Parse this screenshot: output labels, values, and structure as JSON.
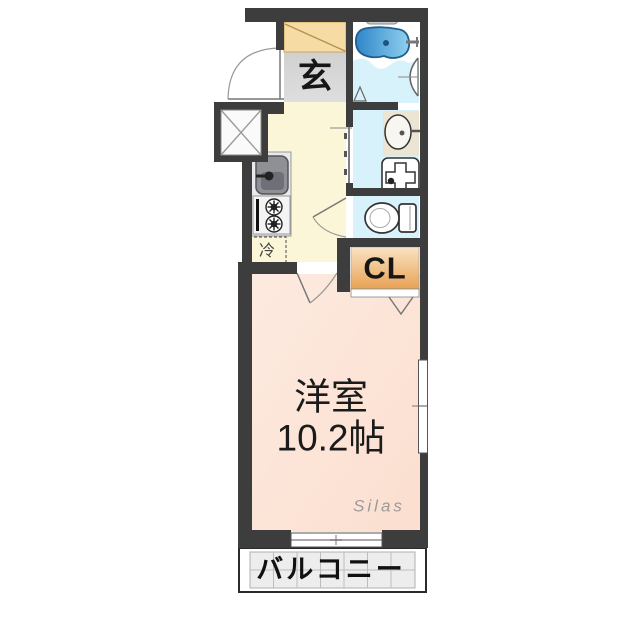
{
  "floorplan": {
    "title": "1K apartment floor plan",
    "labels": {
      "entrance": "玄",
      "closet": "CL",
      "refrigerator": "冷",
      "main_room_name": "洋室",
      "main_room_size": "10.2帖",
      "balcony": "バルコニー",
      "watermark": "Silas"
    },
    "rooms": [
      {
        "name": "entrance",
        "label": "玄"
      },
      {
        "name": "bathroom",
        "label": ""
      },
      {
        "name": "washroom",
        "label": ""
      },
      {
        "name": "toilet",
        "label": ""
      },
      {
        "name": "kitchen",
        "label": ""
      },
      {
        "name": "closet",
        "label": "CL"
      },
      {
        "name": "western-room",
        "label": "洋室 10.2帖"
      },
      {
        "name": "balcony",
        "label": "バルコニー"
      }
    ],
    "fixtures": {
      "bathtub": "bathtub-icon",
      "washbasin": "washbasin-icon",
      "washing_machine_space": "washing-machine-icon",
      "toilet": "toilet-icon",
      "kitchen_sink": "kitchen-sink-icon",
      "stove": "stove-icon",
      "refrigerator_space": "refrigerator-space",
      "shoe_cabinet": "shoe-cabinet",
      "pipe_shaft": "pipe-shaft-x",
      "entrance_door": "door-swing-icon",
      "room_door": "door-swing-icon",
      "toilet_door": "door-swing-icon",
      "washroom_sliding_door": "sliding-door-icon",
      "bath_folding_door": "folding-door-icon",
      "closet_folding_door": "folding-door-icon",
      "windows": "window-icon"
    },
    "colors": {
      "wall": "#3d3d3d",
      "main_room": "#fbdfd0",
      "main_room_light": "#fdeadf",
      "kitchen": "#faf6d7",
      "entrance_floor_dark": "#c9c9c9",
      "entrance_floor_light": "#dedede",
      "shoe_cabinet": "#f7dba4",
      "closet_light": "#f8e4c4",
      "closet_dark": "#e8a254",
      "wet_floor": "#d8f2fb",
      "bath_water_dark": "#2f86c8",
      "bath_water_light": "#8fd0ef",
      "balcony_tile": "#ededed",
      "counter": "#e8e8ed",
      "sink_gray": "#8f8f96"
    }
  }
}
